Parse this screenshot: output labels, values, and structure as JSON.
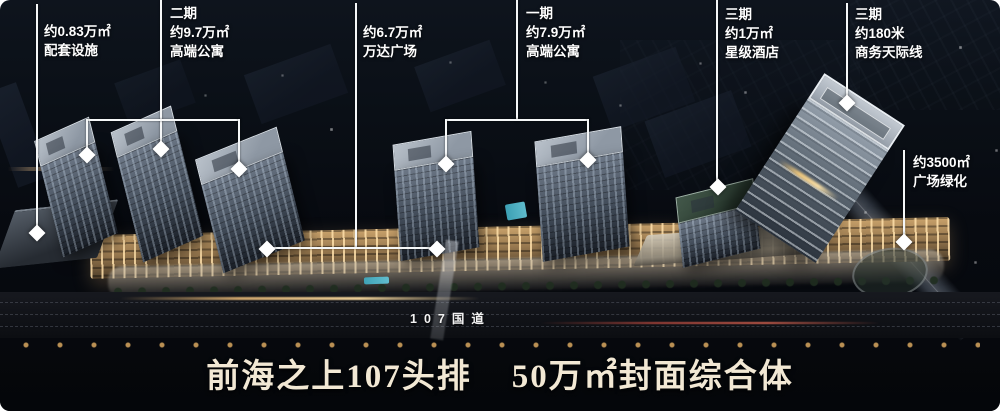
{
  "annotations": [
    {
      "lines": [
        "约0.83万㎡",
        "配套设施"
      ]
    },
    {
      "lines": [
        "二期",
        "约9.7万㎡",
        "高端公寓"
      ]
    },
    {
      "lines": [
        "约6.7万㎡",
        "万达广场"
      ]
    },
    {
      "lines": [
        "一期",
        "约7.9万㎡",
        "高端公寓"
      ]
    },
    {
      "lines": [
        "三期",
        "约1万㎡",
        "星级酒店"
      ]
    },
    {
      "lines": [
        "三期",
        "约180米",
        "商务天际线"
      ]
    },
    {
      "lines": [
        "约3500㎡",
        "广场绿化"
      ]
    }
  ],
  "road_label": "107国道",
  "headline": {
    "part1": "前海之上107头排",
    "part2": "50万㎡封面综合体"
  },
  "colors": {
    "annotation_text": "#ffffff",
    "leader_line": "#f5f7f8",
    "headline_text": "#f2e8d4",
    "mall_lights": "#caa36c",
    "pool": "#3fa8bd",
    "sky": "#0e141d"
  }
}
